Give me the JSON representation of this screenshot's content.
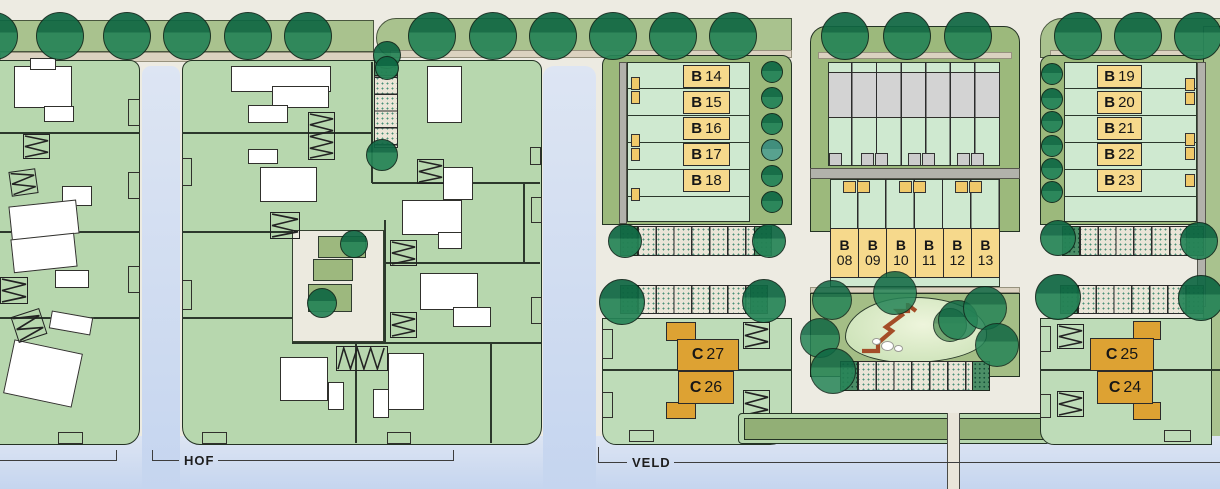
{
  "area_labels": {
    "hof": "HOF",
    "veld": "VELD"
  },
  "plots": {
    "b_left": [
      {
        "p": "B",
        "n": "14"
      },
      {
        "p": "B",
        "n": "15"
      },
      {
        "p": "B",
        "n": "16"
      },
      {
        "p": "B",
        "n": "17"
      },
      {
        "p": "B",
        "n": "18"
      }
    ],
    "b_mid": [
      {
        "p": "B",
        "n": "08"
      },
      {
        "p": "B",
        "n": "09"
      },
      {
        "p": "B",
        "n": "10"
      },
      {
        "p": "B",
        "n": "11"
      },
      {
        "p": "B",
        "n": "12"
      },
      {
        "p": "B",
        "n": "13"
      }
    ],
    "b_right": [
      {
        "p": "B",
        "n": "19"
      },
      {
        "p": "B",
        "n": "20"
      },
      {
        "p": "B",
        "n": "21"
      },
      {
        "p": "B",
        "n": "22"
      },
      {
        "p": "B",
        "n": "23"
      }
    ],
    "c_left": [
      {
        "p": "C",
        "n": "27"
      },
      {
        "p": "C",
        "n": "26"
      }
    ],
    "c_right": [
      {
        "p": "C",
        "n": "25"
      },
      {
        "p": "C",
        "n": "24"
      }
    ]
  },
  "colors": {
    "background": "#edebe2",
    "parcel_green": "#b7d7ae",
    "garden_mint": "#cfe9d0",
    "band_olive": "#a9c28e",
    "block_olive": "#9cb97c",
    "water_blue": "#c9d8f0",
    "plot_yellow": "#f6d98c",
    "plot_orange": "#dda233",
    "building_white": "#ffffff",
    "building_gray": "#d3d3d3",
    "road_gray": "#b2b2ab",
    "tree_green": "#1c7a50",
    "play_path_red": "#a44d28"
  }
}
